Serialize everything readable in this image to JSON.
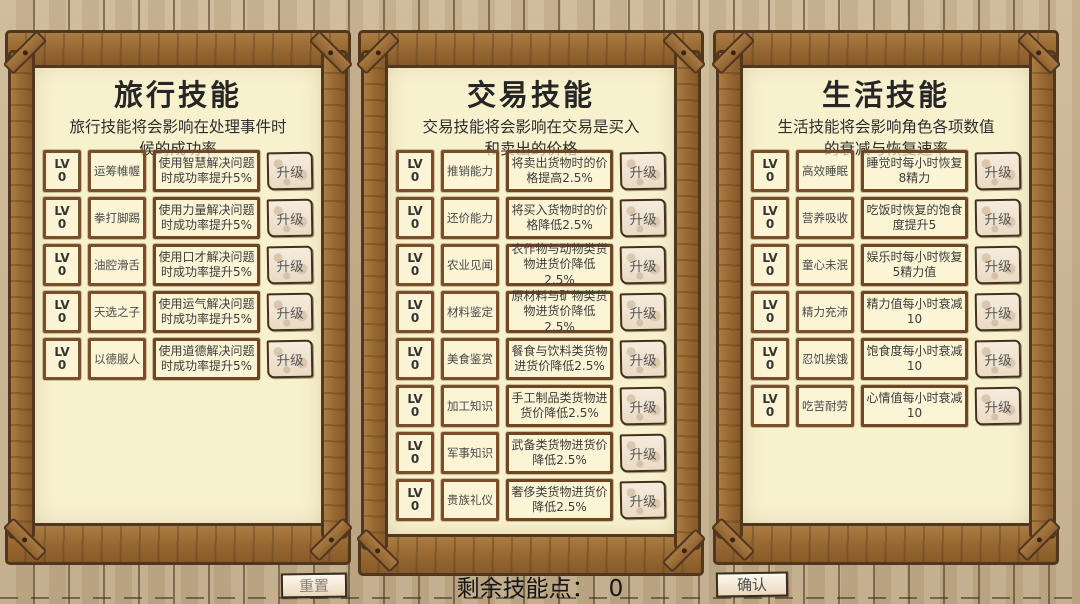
{
  "colors": {
    "background": "#c7b291",
    "frame_wood": "#9a6a33",
    "frame_outline": "#513620",
    "paper": "#f8f1cd",
    "box_border": "#7a4e28",
    "button_parchment": "#f1e7d5",
    "text": "#3a3a3a"
  },
  "panels": [
    {
      "title": "旅行技能",
      "subtitle": [
        "旅行技能将会影响在处理事件时",
        "候的成功率"
      ],
      "rows": [
        {
          "lv_label": "LV",
          "lv_value": "0",
          "name": "运筹帷幄",
          "desc": "使用智慧解决问题时成功率提升5%",
          "upgrade": "升级"
        },
        {
          "lv_label": "LV",
          "lv_value": "0",
          "name": "拳打脚踢",
          "desc": "使用力量解决问题时成功率提升5%",
          "upgrade": "升级"
        },
        {
          "lv_label": "LV",
          "lv_value": "0",
          "name": "油腔滑舌",
          "desc": "使用口才解决问题时成功率提升5%",
          "upgrade": "升级"
        },
        {
          "lv_label": "LV",
          "lv_value": "0",
          "name": "天选之子",
          "desc": "使用运气解决问题时成功率提升5%",
          "upgrade": "升级"
        },
        {
          "lv_label": "LV",
          "lv_value": "0",
          "name": "以德服人",
          "desc": "使用道德解决问题时成功率提升5%",
          "upgrade": "升级"
        }
      ]
    },
    {
      "title": "交易技能",
      "subtitle": [
        "交易技能将会影响在交易是买入",
        "和卖出的价格"
      ],
      "rows": [
        {
          "lv_label": "LV",
          "lv_value": "0",
          "name": "推销能力",
          "desc": "将卖出货物时的价格提高2.5%",
          "upgrade": "升级"
        },
        {
          "lv_label": "LV",
          "lv_value": "0",
          "name": "还价能力",
          "desc": "将买入货物时的价格降低2.5%",
          "upgrade": "升级"
        },
        {
          "lv_label": "LV",
          "lv_value": "0",
          "name": "农业见闻",
          "desc": "农作物与动物类货物进货价降低2.5%",
          "upgrade": "升级"
        },
        {
          "lv_label": "LV",
          "lv_value": "0",
          "name": "材料鉴定",
          "desc": "原材料与矿物类货物进货价降低2.5%",
          "upgrade": "升级"
        },
        {
          "lv_label": "LV",
          "lv_value": "0",
          "name": "美食鉴赏",
          "desc": "餐食与饮料类货物进货价降低2.5%",
          "upgrade": "升级"
        },
        {
          "lv_label": "LV",
          "lv_value": "0",
          "name": "加工知识",
          "desc": "手工制品类货物进货价降低2.5%",
          "upgrade": "升级"
        },
        {
          "lv_label": "LV",
          "lv_value": "0",
          "name": "军事知识",
          "desc": "武备类货物进货价降低2.5%",
          "upgrade": "升级"
        },
        {
          "lv_label": "LV",
          "lv_value": "0",
          "name": "贵族礼仪",
          "desc": "奢侈类货物进货价降低2.5%",
          "upgrade": "升级"
        }
      ]
    },
    {
      "title": "生活技能",
      "subtitle": [
        "生活技能将会影响角色各项数值",
        "的衰减与恢复速率"
      ],
      "rows": [
        {
          "lv_label": "LV",
          "lv_value": "0",
          "name": "高效睡眠",
          "desc": "睡觉时每小时恢复8精力",
          "upgrade": "升级"
        },
        {
          "lv_label": "LV",
          "lv_value": "0",
          "name": "营养吸收",
          "desc": "吃饭时恢复的饱食度提升5",
          "upgrade": "升级"
        },
        {
          "lv_label": "LV",
          "lv_value": "0",
          "name": "童心未泯",
          "desc": "娱乐时每小时恢复5精力值",
          "upgrade": "升级"
        },
        {
          "lv_label": "LV",
          "lv_value": "0",
          "name": "精力充沛",
          "desc": "精力值每小时衰减10",
          "upgrade": "升级"
        },
        {
          "lv_label": "LV",
          "lv_value": "0",
          "name": "忍饥挨饿",
          "desc": "饱食度每小时衰减10",
          "upgrade": "升级"
        },
        {
          "lv_label": "LV",
          "lv_value": "0",
          "name": "吃苦耐劳",
          "desc": "心情值每小时衰减10",
          "upgrade": "升级"
        }
      ]
    }
  ],
  "bottom_bar": {
    "reset_label": "重置",
    "points_label": "剩余技能点：",
    "points_value": "0",
    "confirm_label": "确认"
  }
}
